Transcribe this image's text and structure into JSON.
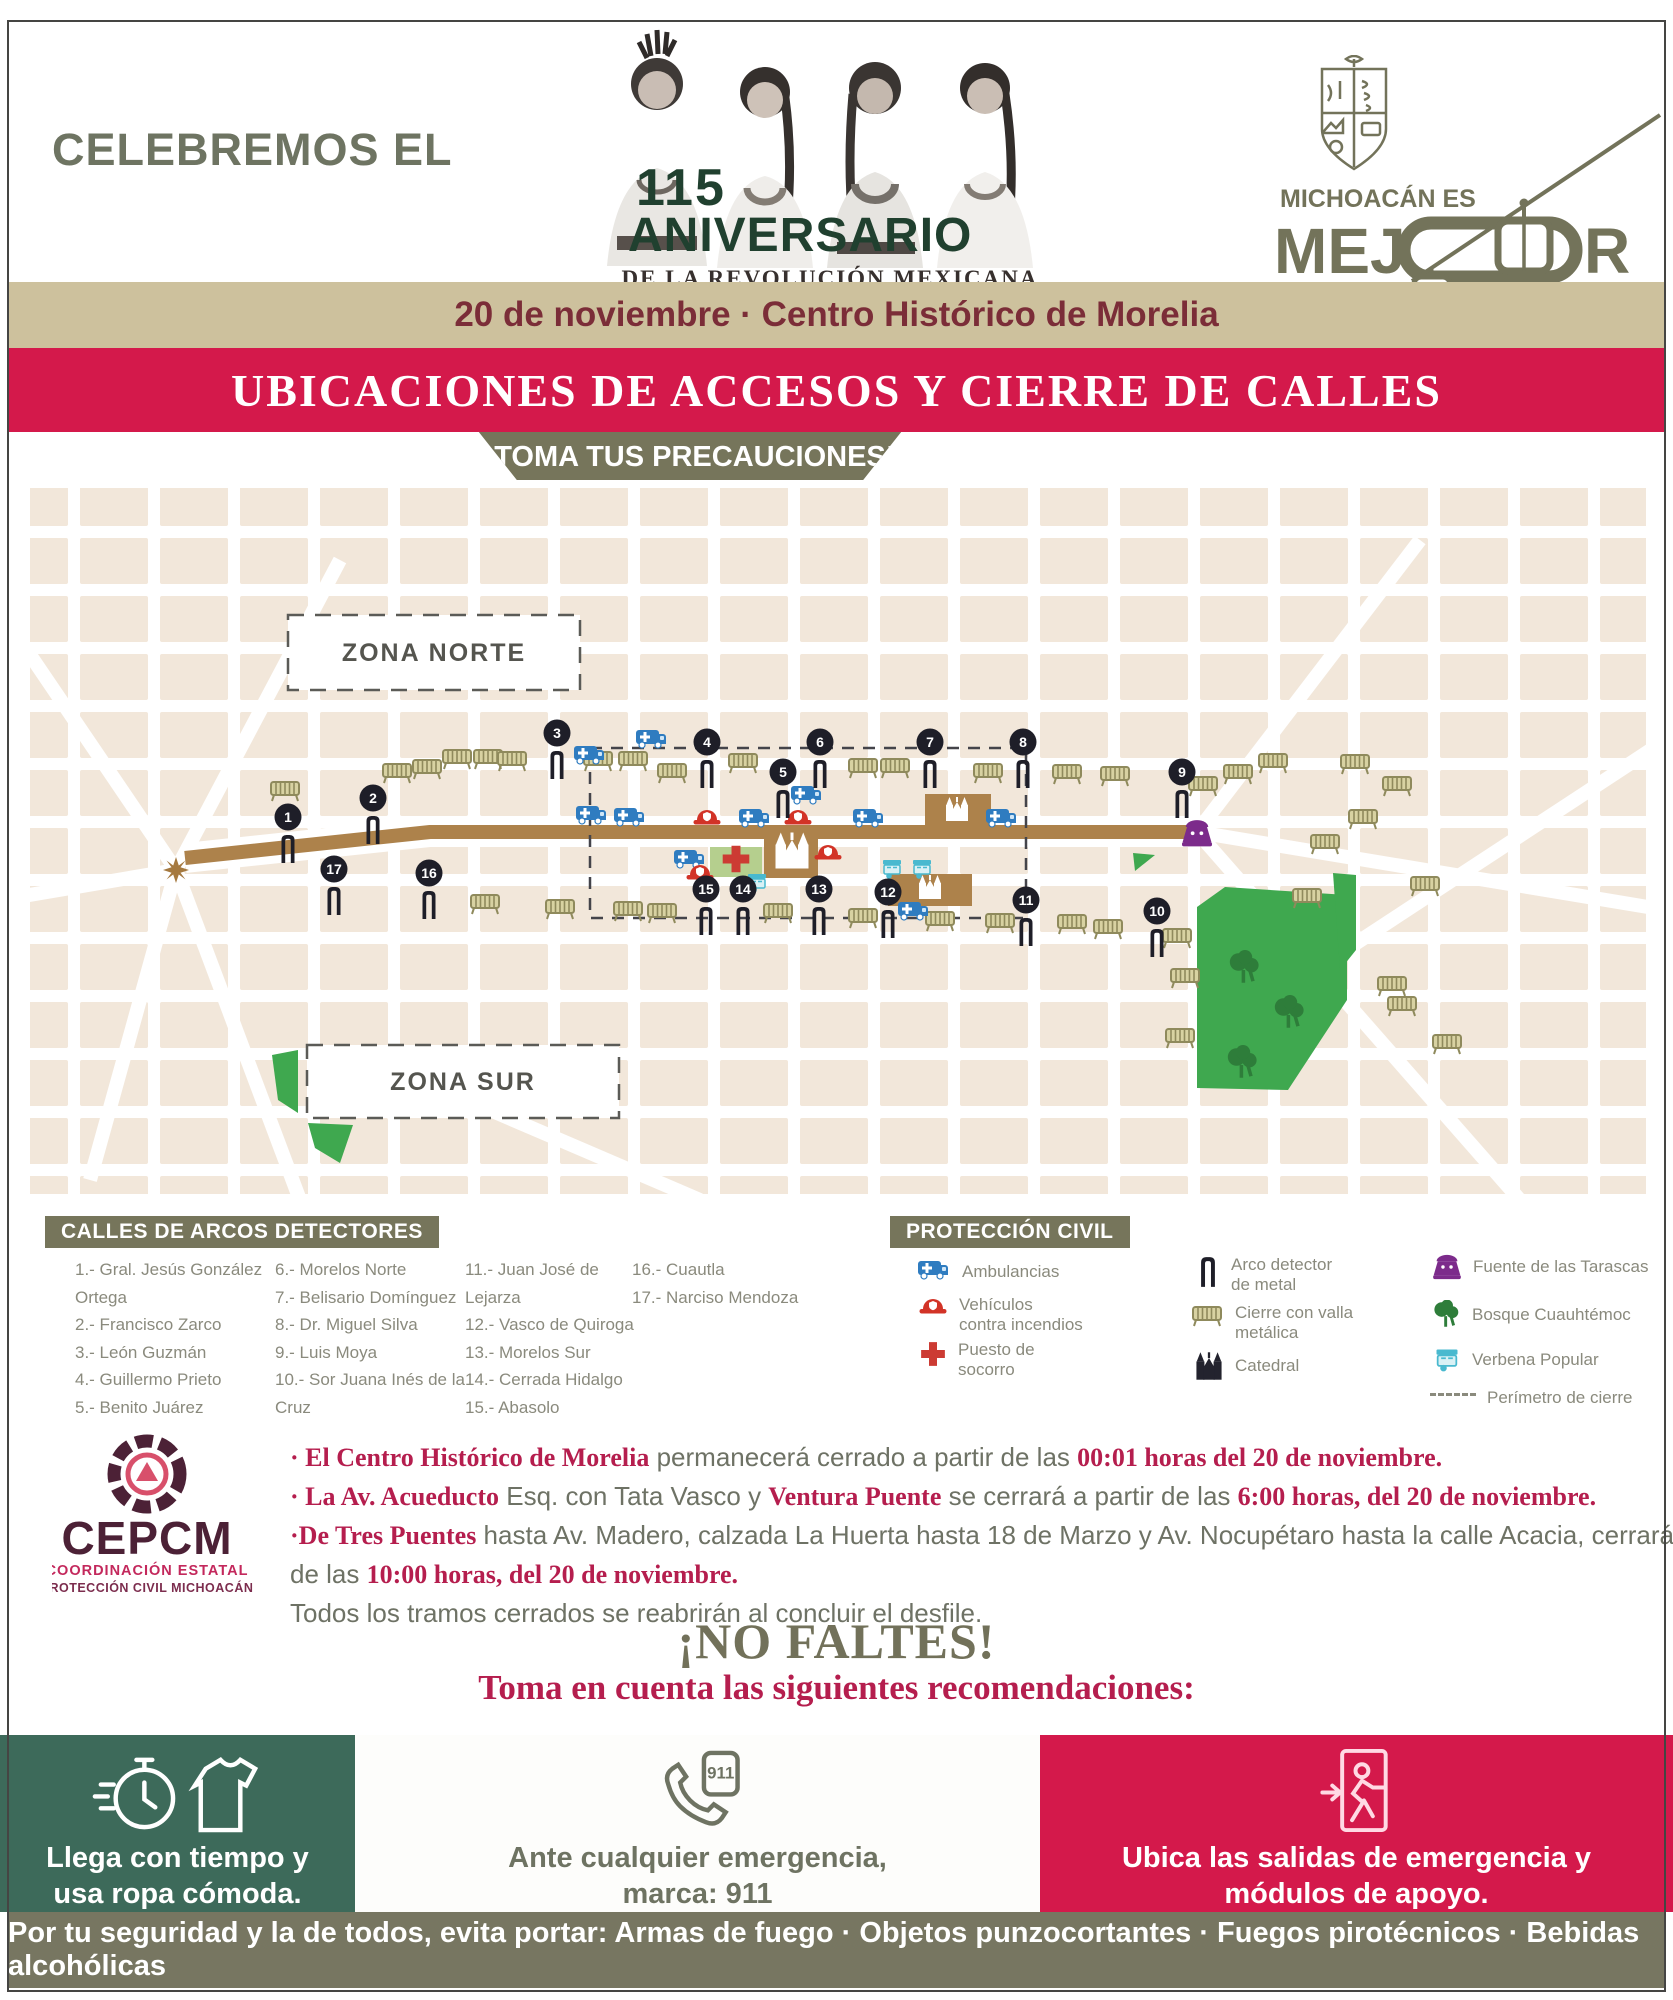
{
  "colors": {
    "accent_red": "#d4194b",
    "olive": "#76755b",
    "panel_green": "#3d6a5a",
    "tan_banner": "#cdc19d",
    "maroon_text": "#7b2d38",
    "crimson_text": "#b51e4e",
    "park_green": "#3fa84f",
    "route_brown": "#ad824b",
    "ambulance_blue": "#2f7cc0",
    "fountain_purple": "#7c2b8b"
  },
  "header": {
    "celebremos": "CELEBREMOS EL",
    "logo": {
      "number": "115",
      "title": "ANIVERSARIO",
      "subtitle": "DE LA REVOLUCIÓN MEXICANA",
      "script": "Desfile Cívico Deportivo"
    },
    "brand": {
      "top": "MICHOACÁN ES",
      "word_pre": "MEJ",
      "word_post": "R"
    }
  },
  "banners": {
    "date": "20 de noviembre · Centro Histórico de Morelia",
    "title": "UBICACIONES DE ACCESOS Y CIERRE DE CALLES",
    "warning": "¡TOMA TUS PRECAUCIONES!"
  },
  "map": {
    "zona_norte": "ZONA NORTE",
    "zona_sur": "ZONA SUR",
    "markers": [
      [
        1,
        288,
        337
      ],
      [
        2,
        373,
        318
      ],
      [
        3,
        557,
        253
      ],
      [
        4,
        707,
        262
      ],
      [
        5,
        783,
        292
      ],
      [
        6,
        820,
        262
      ],
      [
        7,
        930,
        262
      ],
      [
        8,
        1023,
        262
      ],
      [
        9,
        1182,
        292
      ],
      [
        10,
        1157,
        431
      ],
      [
        11,
        1026,
        420
      ],
      [
        12,
        888,
        412
      ],
      [
        13,
        819,
        409
      ],
      [
        14,
        743,
        409
      ],
      [
        15,
        706,
        409
      ],
      [
        16,
        429,
        393
      ],
      [
        17,
        334,
        389
      ]
    ],
    "barriers": [
      [
        285,
        310
      ],
      [
        397,
        292
      ],
      [
        427,
        288
      ],
      [
        457,
        278
      ],
      [
        488,
        278
      ],
      [
        512,
        280
      ],
      [
        598,
        280
      ],
      [
        485,
        423
      ],
      [
        560,
        428
      ],
      [
        633,
        280
      ],
      [
        672,
        292
      ],
      [
        743,
        282
      ],
      [
        863,
        287
      ],
      [
        895,
        287
      ],
      [
        988,
        292
      ],
      [
        1067,
        293
      ],
      [
        628,
        430
      ],
      [
        662,
        432
      ],
      [
        778,
        432
      ],
      [
        863,
        437
      ],
      [
        940,
        440
      ],
      [
        1000,
        442
      ],
      [
        1072,
        443
      ],
      [
        1115,
        295
      ],
      [
        1203,
        305
      ],
      [
        1238,
        293
      ],
      [
        1273,
        282
      ],
      [
        1355,
        283
      ],
      [
        1397,
        305
      ],
      [
        1363,
        338
      ],
      [
        1325,
        363
      ],
      [
        1425,
        405
      ],
      [
        1307,
        417
      ],
      [
        1108,
        448
      ],
      [
        1177,
        457
      ],
      [
        1185,
        497
      ],
      [
        1392,
        505
      ],
      [
        1402,
        525
      ],
      [
        1180,
        557
      ],
      [
        1447,
        563
      ]
    ],
    "ambulances": [
      [
        650,
        259
      ],
      [
        588,
        275
      ],
      [
        628,
        337
      ],
      [
        753,
        338
      ],
      [
        805,
        315
      ],
      [
        867,
        338
      ],
      [
        1000,
        338
      ],
      [
        688,
        379
      ],
      [
        912,
        431
      ],
      [
        590,
        335
      ]
    ],
    "fire_vehicles": [
      [
        707,
        338
      ],
      [
        798,
        338
      ],
      [
        828,
        373
      ],
      [
        700,
        393
      ]
    ],
    "aid_posts": [
      [
        736,
        379
      ]
    ],
    "verbenas": [
      [
        757,
        402
      ],
      [
        892,
        388
      ],
      [
        922,
        388
      ]
    ],
    "trees": [
      [
        1245,
        490
      ],
      [
        1290,
        535
      ],
      [
        1243,
        585
      ]
    ],
    "churches": [
      [
        957,
        330
      ],
      [
        930,
        408
      ]
    ],
    "cathedral": [
      792,
      372
    ],
    "fountain": [
      1197,
      352
    ],
    "star": [
      176,
      390
    ]
  },
  "legend_calles": {
    "title": "CALLES DE ARCOS DETECTORES",
    "col1": [
      "1.- Gral. Jesús González Ortega",
      "2.- Francisco Zarco",
      "3.- León Guzmán",
      "4.- Guillermo Prieto",
      "5.- Benito Juárez"
    ],
    "col2": [
      "6.- Morelos Norte",
      "7.- Belisario Domínguez",
      "8.- Dr. Miguel Silva",
      "9.- Luis Moya",
      "10.- Sor Juana Inés de la Cruz"
    ],
    "col3": [
      "11.- Juan José de Lejarza",
      "12.- Vasco de Quiroga",
      "13.- Morelos Sur",
      "14.- Cerrada Hidalgo",
      "15.- Abasolo"
    ],
    "col4": [
      "16.- Cuautla",
      "17.- Narciso Mendoza"
    ]
  },
  "legend_pc": {
    "title": "PROTECCIÓN CIVIL",
    "items": [
      {
        "icon": "ambulance-icon",
        "label": "Ambulancias"
      },
      {
        "icon": "fire-helmet-icon",
        "label": "Vehículos contra incendios"
      },
      {
        "icon": "first-aid-cross-icon",
        "label": "Puesto de socorro"
      },
      {
        "icon": "metal-detector-arch-icon",
        "label": "Arco detector de metal"
      },
      {
        "icon": "metal-barrier-icon",
        "label": "Cierre con valla metálica"
      },
      {
        "icon": "cathedral-icon",
        "label": "Catedral"
      },
      {
        "icon": "fountain-icon",
        "label": "Fuente de las Tarascas"
      },
      {
        "icon": "tree-icon",
        "label": "Bosque Cuauhtémoc"
      },
      {
        "icon": "street-cart-icon",
        "label": "Verbena Popular"
      },
      {
        "icon": "dashed-line-icon",
        "label": "Perímetro de cierre"
      }
    ]
  },
  "cepcm": {
    "acronym": "CEPCM",
    "line1": "COORDINACIÓN ESTATAL",
    "line2": "PROTECCIÓN CIVIL MICHOACÁN"
  },
  "notices": {
    "lines": [
      [
        {
          "h": 1,
          "t": "· El Centro Histórico de Morelia"
        },
        {
          "t": " permanecerá cerrado a partir de las "
        },
        {
          "h": 1,
          "t": "00:01 horas del 20 de noviembre."
        }
      ],
      [
        {
          "h": 1,
          "t": "· La Av. Acueducto"
        },
        {
          "t": " Esq. con Tata Vasco y "
        },
        {
          "h": 1,
          "t": "Ventura Puente"
        },
        {
          "t": " se cerrará a partir de las "
        },
        {
          "h": 1,
          "t": "6:00 horas, del 20 de noviembre."
        }
      ],
      [
        {
          "h": 1,
          "t": "·De Tres Puentes"
        },
        {
          "t": " hasta Av. Madero, calzada La Huerta hasta 18 de Marzo y Av. Nocupétaro hasta la calle Acacia, cerrarán a partir"
        }
      ],
      [
        {
          "t": "de las "
        },
        {
          "h": 1,
          "t": "10:00 horas, del 20 de noviembre."
        }
      ],
      [
        {
          "t": "Todos los tramos cerrados se reabrirán al concluir el desfile."
        }
      ]
    ]
  },
  "no_faltes": {
    "title": "¡NO FALTES!",
    "subtitle": "Toma en cuenta las siguientes recomendaciones:"
  },
  "panels": [
    {
      "icon": "stopwatch-shirt-icon",
      "lines": [
        "Llega con tiempo y",
        "usa ropa cómoda."
      ]
    },
    {
      "icon": "phone-911-icon",
      "badge": "911",
      "lines": [
        "Ante cualquier emergencia,",
        "marca: 911"
      ]
    },
    {
      "icon": "emergency-exit-icon",
      "lines": [
        "Ubica las salidas de emergencia y",
        "módulos de apoyo."
      ]
    }
  ],
  "footer": {
    "text": "Por tu seguridad y la de todos, evita portar: Armas de fuego · Objetos punzocortantes · Fuegos pirotécnicos · Bebidas alcohólicas"
  }
}
